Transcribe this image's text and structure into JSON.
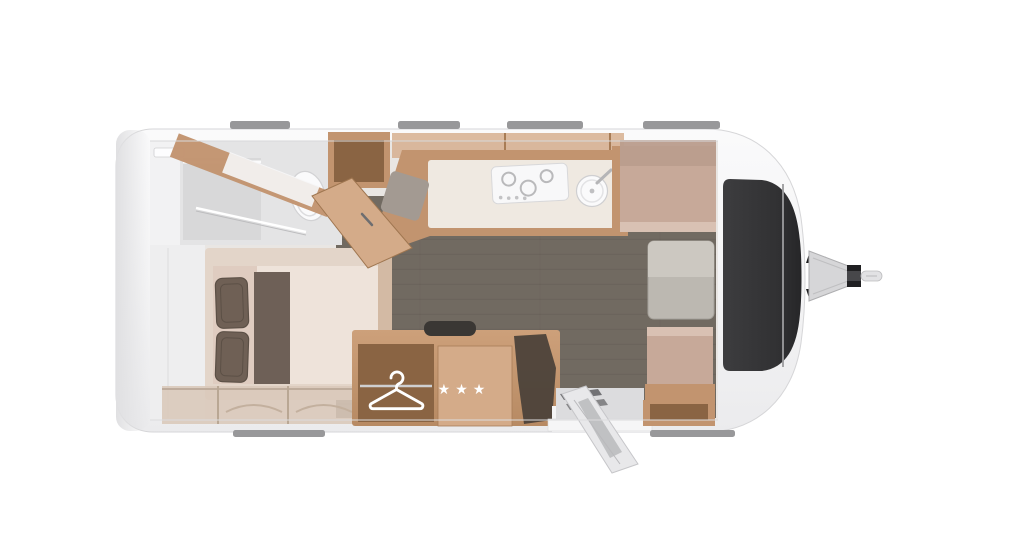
{
  "scene": {
    "title": "Caravan floor plan top view",
    "background": "#ffffff"
  },
  "colors": {
    "shell": "#f5f5f6",
    "shell_edge": "#d9d9db",
    "interior": "#e9e6e3",
    "floor": "#716a61",
    "wood_light": "#d4ab89",
    "wood_mid": "#c2946f",
    "wood_dark": "#8a6443",
    "worktop": "#efe9e1",
    "cushion": "#c7a999",
    "cushion_light": "#d9c1b3",
    "cushion_back": "#bb9d8d",
    "mattress": "#eee3da",
    "bed_platform": "#e3d5c9",
    "pillow": "#6f6055",
    "runner": "#6e6057",
    "table": "#bcb8b1",
    "table_light": "#ccc8c1",
    "window_dark": "#333335",
    "white_fixture": "#fafafb",
    "shower": "#d8d8d9",
    "metal": "#d6d6d8",
    "roof_mark": "#98989a",
    "drape": "#494038",
    "step_dark": "#5f5f63"
  },
  "fridge": {
    "stars_text": "★★★",
    "star_count": 3
  },
  "wardrobe": {
    "icon": "clothes-hanger-icon"
  },
  "floorplan": {
    "vehicle": "caravan-travel-trailer-top-view",
    "front_end": "right-with-tow-hitch",
    "rear_end": "left",
    "areas": [
      {
        "id": "washroom",
        "name": "washroom with shower and toilet",
        "position": "rear-top-left"
      },
      {
        "id": "bed",
        "name": "double bed with two pillows and runner",
        "position": "rear-bottom-left"
      },
      {
        "id": "kitchen",
        "name": "kitchen with hob and round sink",
        "position": "top-center"
      },
      {
        "id": "wardrobe",
        "name": "wardrobe with clothes rail and hanger",
        "position": "bottom-center"
      },
      {
        "id": "fridge",
        "name": "refrigerator with three-star freezer marking",
        "position": "bottom-center"
      },
      {
        "id": "dinette",
        "name": "front dinette with two facing benches and table",
        "position": "front-right"
      },
      {
        "id": "entry-door",
        "name": "entry door shown open with step",
        "position": "bottom-center-right"
      },
      {
        "id": "front-window",
        "name": "dark panoramic front window band",
        "position": "front"
      },
      {
        "id": "tow-hitch",
        "name": "tow hitch drawbar and coupling",
        "position": "front-exterior"
      }
    ],
    "roof_marks": {
      "top_count": 4,
      "bottom_count": 2
    }
  }
}
